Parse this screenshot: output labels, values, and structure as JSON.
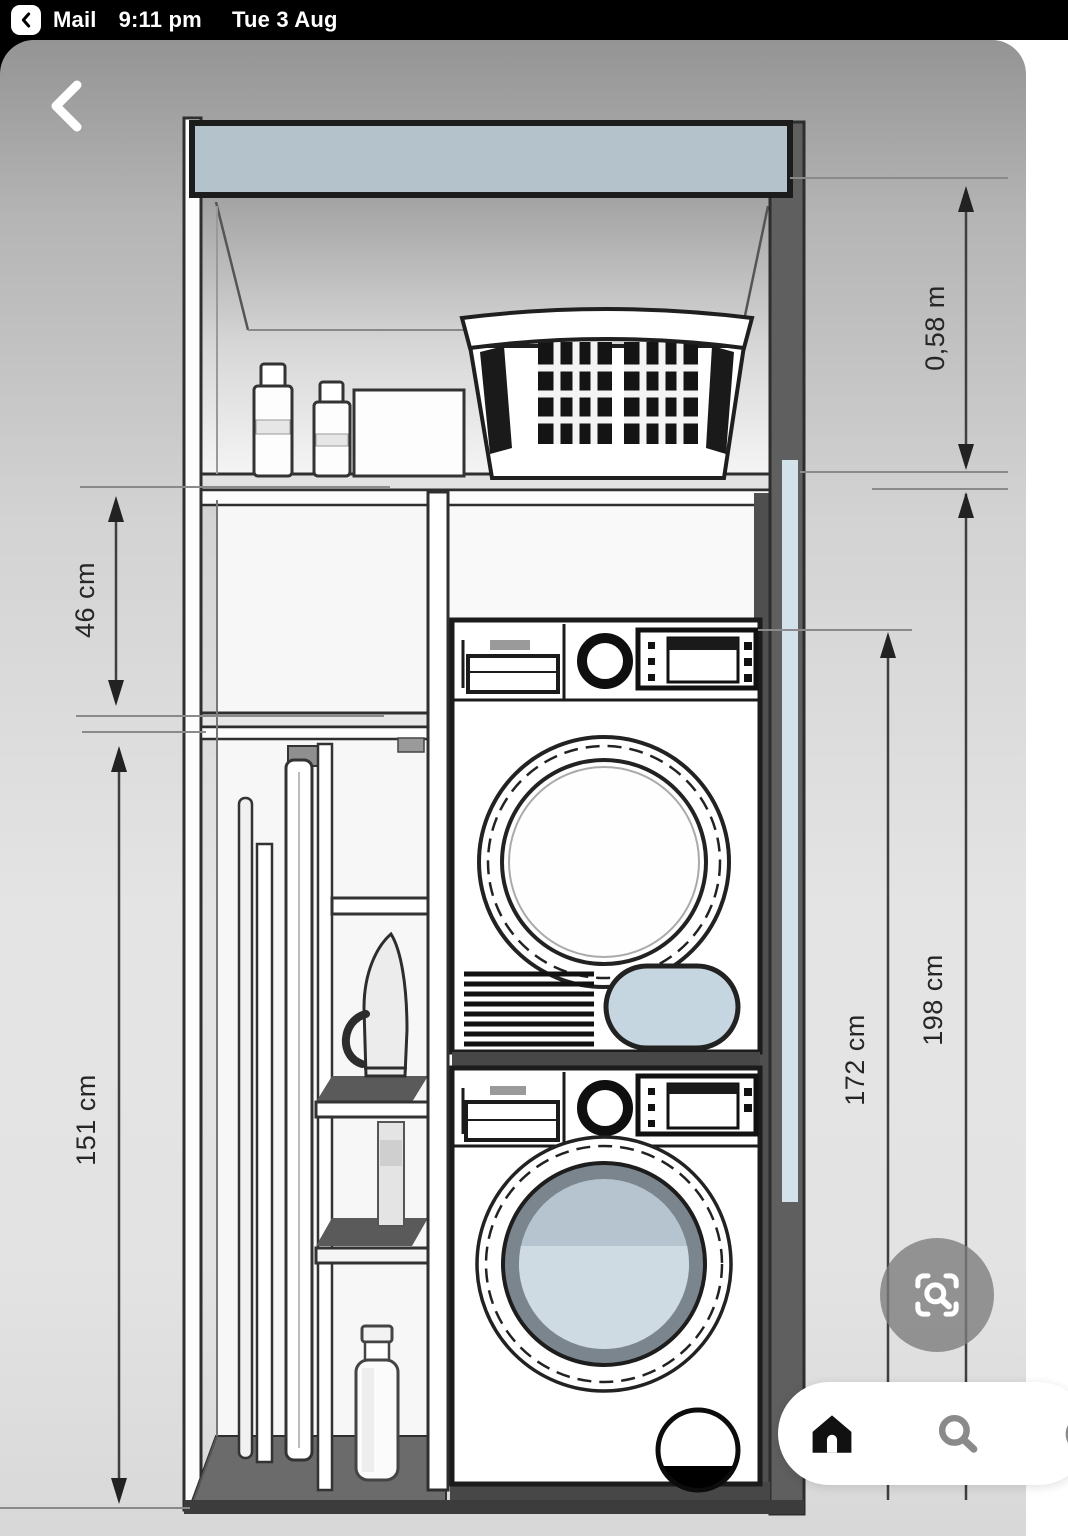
{
  "status_bar": {
    "back_to_app": "Mail",
    "time": "9:11 pm",
    "date": "Tue 3 Aug"
  },
  "overlay": {
    "back_icon": "chevron-left-icon",
    "lens_icon": "visual-search-lens-icon"
  },
  "bottom_bar": {
    "icons": [
      "home-icon",
      "search-icon",
      "partial-right-icon"
    ]
  },
  "diagram": {
    "type": "technical-drawing",
    "subject": "Tall laundry cabinet elevation: dryer stacked on washer, top shelf with laundry basket, detergent bottles and box, left compartment with ironing board, broom, iron and small shelves",
    "dimensions": [
      {
        "label": "0,58 m",
        "position": "top-right",
        "orientation": "vertical"
      },
      {
        "label": "46 cm",
        "position": "upper-left",
        "orientation": "vertical"
      },
      {
        "label": "151 cm",
        "position": "lower-left",
        "orientation": "vertical"
      },
      {
        "label": "172 cm",
        "position": "right-inner",
        "orientation": "vertical"
      },
      {
        "label": "198 cm",
        "position": "right-outer",
        "orientation": "vertical"
      }
    ],
    "colors": {
      "pelmet_blue_gray": "#b4c2cc",
      "glass_blue": "#cfdbe2",
      "pill_blue": "#c6d6e0",
      "cabinet_gray": "#5f5f5f",
      "line": "#1b1b1b"
    }
  }
}
